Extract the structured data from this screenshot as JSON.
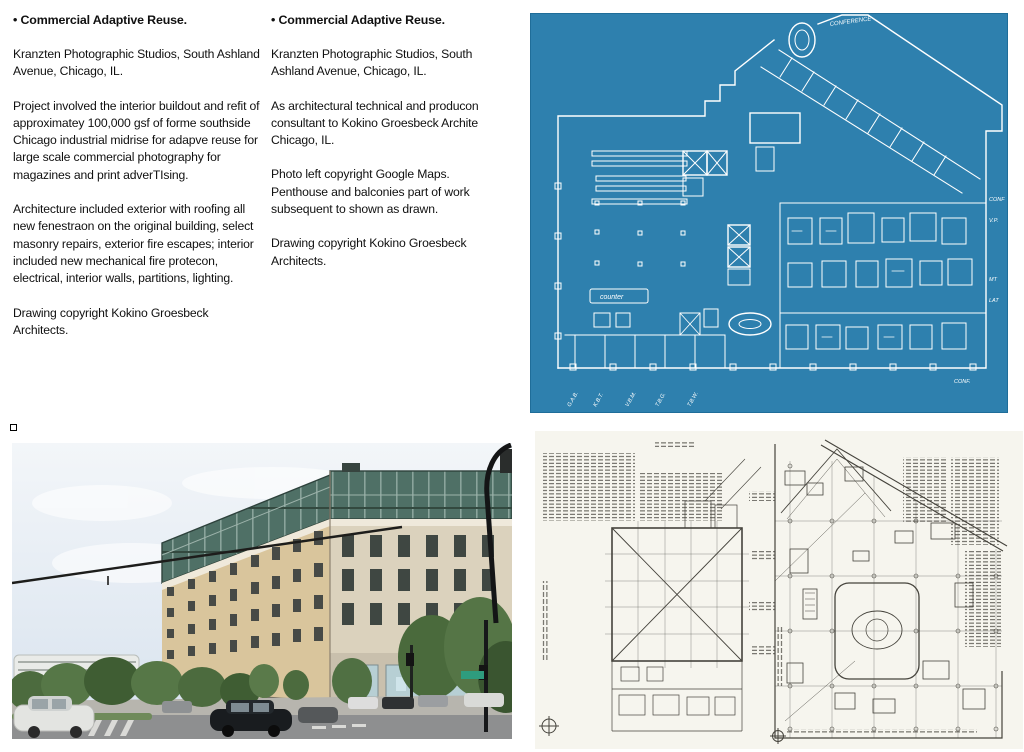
{
  "columns": [
    {
      "bullet": "•",
      "heading": "Commercial Adaptive Reuse.",
      "paragraphs": [
        "Kranzten Photographic Studios, South Ashland Avenue, Chicago, IL.",
        "Project involved the interior buildout and refit of approximatey 100,000 gsf of forme southside Chicago industrial midrise for adapve reuse for large scale commercial photography for magazines and print adverTIsing.",
        "Architecture included exterior with roofing all new fenestraon on the original building, select masonry repairs, exterior fire escapes; interior included new mechanical fire protecon, electrical, interior walls, partitions, lighting.",
        "Drawing copyright Kokino Groesbeck Architects."
      ]
    },
    {
      "bullet": "•",
      "heading": "Commercial Adaptive Reuse.",
      "paragraphs": [
        "Kranzten Photographic Studios, South Ashland Avenue, Chicago, IL.",
        "As architectural technical and producon consultant to Kokino Groesbeck Archite Chicago, IL.",
        "Photo left copyright Google Maps. Penthouse and balconies part of work subsequent to shown as drawn.",
        "Drawing copyright Kokino Groesbeck Architects."
      ]
    }
  ],
  "blueprint": {
    "background": "#2e80ae",
    "line_color": "#ffffff",
    "labels": {
      "top": "CONFERENCE",
      "counter": "counter",
      "right": [
        "CONF",
        "V.P.",
        "MT",
        "LAT"
      ],
      "bottom": [
        "G.A.B.",
        "K.B.T.",
        "V.B.M.",
        "T.B.G.",
        "T.B.W."
      ],
      "bottom_right": "CONF."
    }
  },
  "photo": {
    "colors": {
      "sky_top": "#f3f6f9",
      "sky_bottom": "#d7e2ee",
      "masonry_left": "#d9c59c",
      "masonry_right": "#dbd2bd",
      "glass_penthouse": "#4f7066",
      "balcony_dark": "#343a3b",
      "tree_green": "#4c6b3e",
      "road_gray": "#8e8f90",
      "awning_red": "#bf3b3b"
    }
  },
  "drawing": {
    "background": "#f6f5ee",
    "line_color": "#45433c"
  }
}
